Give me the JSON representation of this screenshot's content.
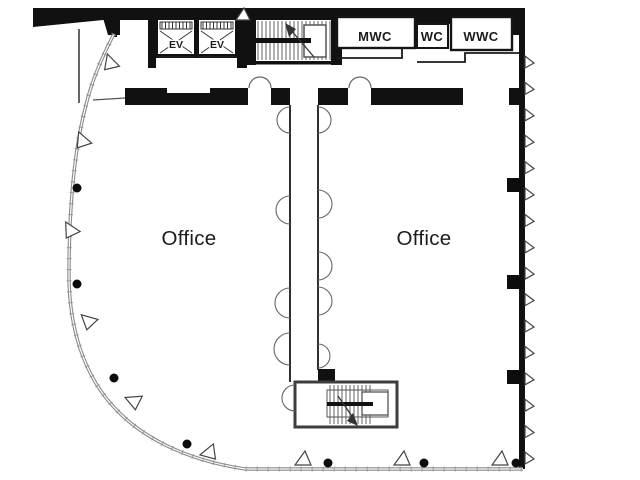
{
  "diagram": {
    "type": "office-floor-plan",
    "labels": {
      "office_left": "Office",
      "office_right": "Office",
      "mwc": "MWC",
      "wc": "WC",
      "wwc": "WWC",
      "ev_1": "EV",
      "ev_2": "EV"
    },
    "colors": {
      "background": "#ffffff",
      "wall": "#111111",
      "thin_wall": "#1a1a1a",
      "stair_wall": "#3d3d3d",
      "stair_detail": "#555555",
      "tread": "#3a3a3a",
      "glass_wall": "#8a8a8a",
      "glass_tick": "#8f8f8f",
      "door_arc": "#666666",
      "vent_stroke": "#444444",
      "column": "#0d0d0d",
      "label_text": "#1c1c1c"
    }
  }
}
